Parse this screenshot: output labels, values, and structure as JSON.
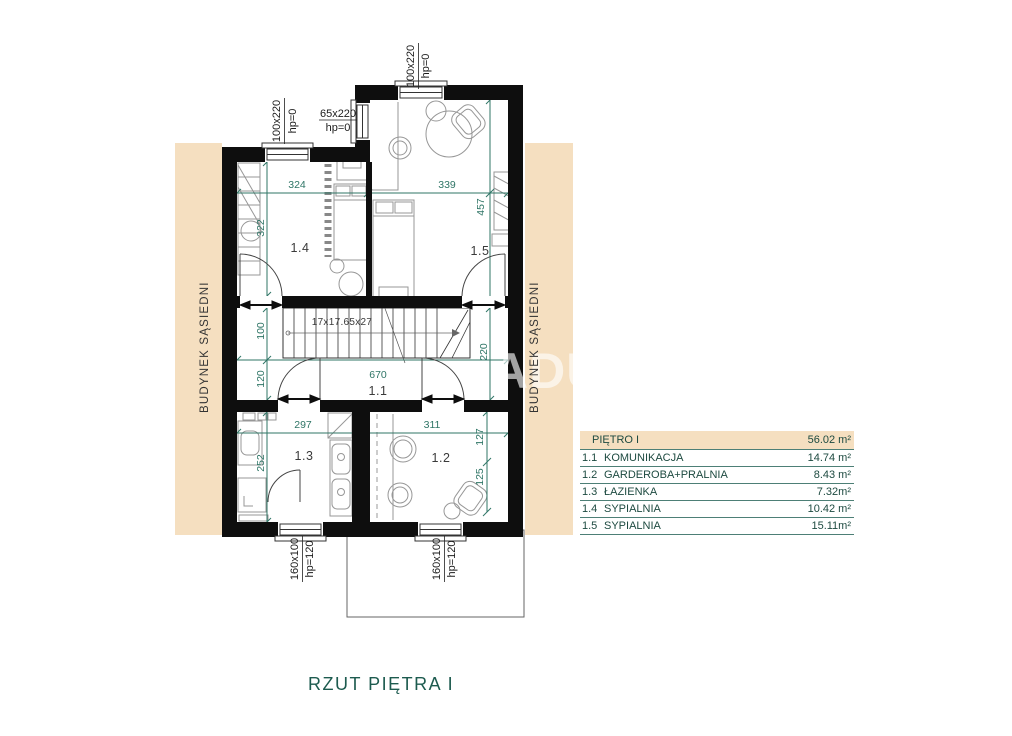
{
  "plan": {
    "title": "RZUT PIĘTRA I",
    "neighbor_label_left": "BUDYNEK SĄSIEDNI",
    "neighbor_label_right": "BUDYNEK SĄSIEDNI",
    "watermark": "ADU",
    "stairs_label": "17x17.65x27"
  },
  "rooms": {
    "r1_1": "1.1",
    "r1_2": "1.2",
    "r1_3": "1.3",
    "r1_4": "1.4",
    "r1_5": "1.5"
  },
  "windows": {
    "top_left": {
      "size": "100x220",
      "hp": "hp=0"
    },
    "side_left": {
      "size": "65x220",
      "hp": "hp=0"
    },
    "top_right": {
      "size": "100x220",
      "hp": "hp=0"
    },
    "bottom_left": {
      "size": "160x100",
      "hp": "hp=120"
    },
    "bottom_right": {
      "size": "160x100",
      "hp": "hp=120"
    }
  },
  "dims": {
    "w324": "324",
    "w339": "339",
    "h322": "322",
    "h457": "457",
    "h100": "100",
    "h120": "120",
    "h220": "220",
    "w670": "670",
    "w297": "297",
    "w311": "311",
    "h252": "252",
    "h127": "127",
    "h125": "125"
  },
  "legend": {
    "header": {
      "label": "PIĘTRO I",
      "area": "56.02 m²"
    },
    "rows": [
      {
        "num": "1.1",
        "name": "KOMUNIKACJA",
        "area": "14.74 m²"
      },
      {
        "num": "1.2",
        "name": "GARDEROBA+PRALNIA",
        "area": "8.43 m²"
      },
      {
        "num": "1.3",
        "name": "ŁAZIENKA",
        "area": "7.32m²"
      },
      {
        "num": "1.4",
        "name": "SYPIALNIA",
        "area": "10.42 m²"
      },
      {
        "num": "1.5",
        "name": "SYPIALNIA",
        "area": "15.11m²"
      }
    ]
  },
  "colors": {
    "accent_teal": "#2f7566",
    "beige": "#f5dfc0",
    "wall": "#0e0e0e"
  }
}
